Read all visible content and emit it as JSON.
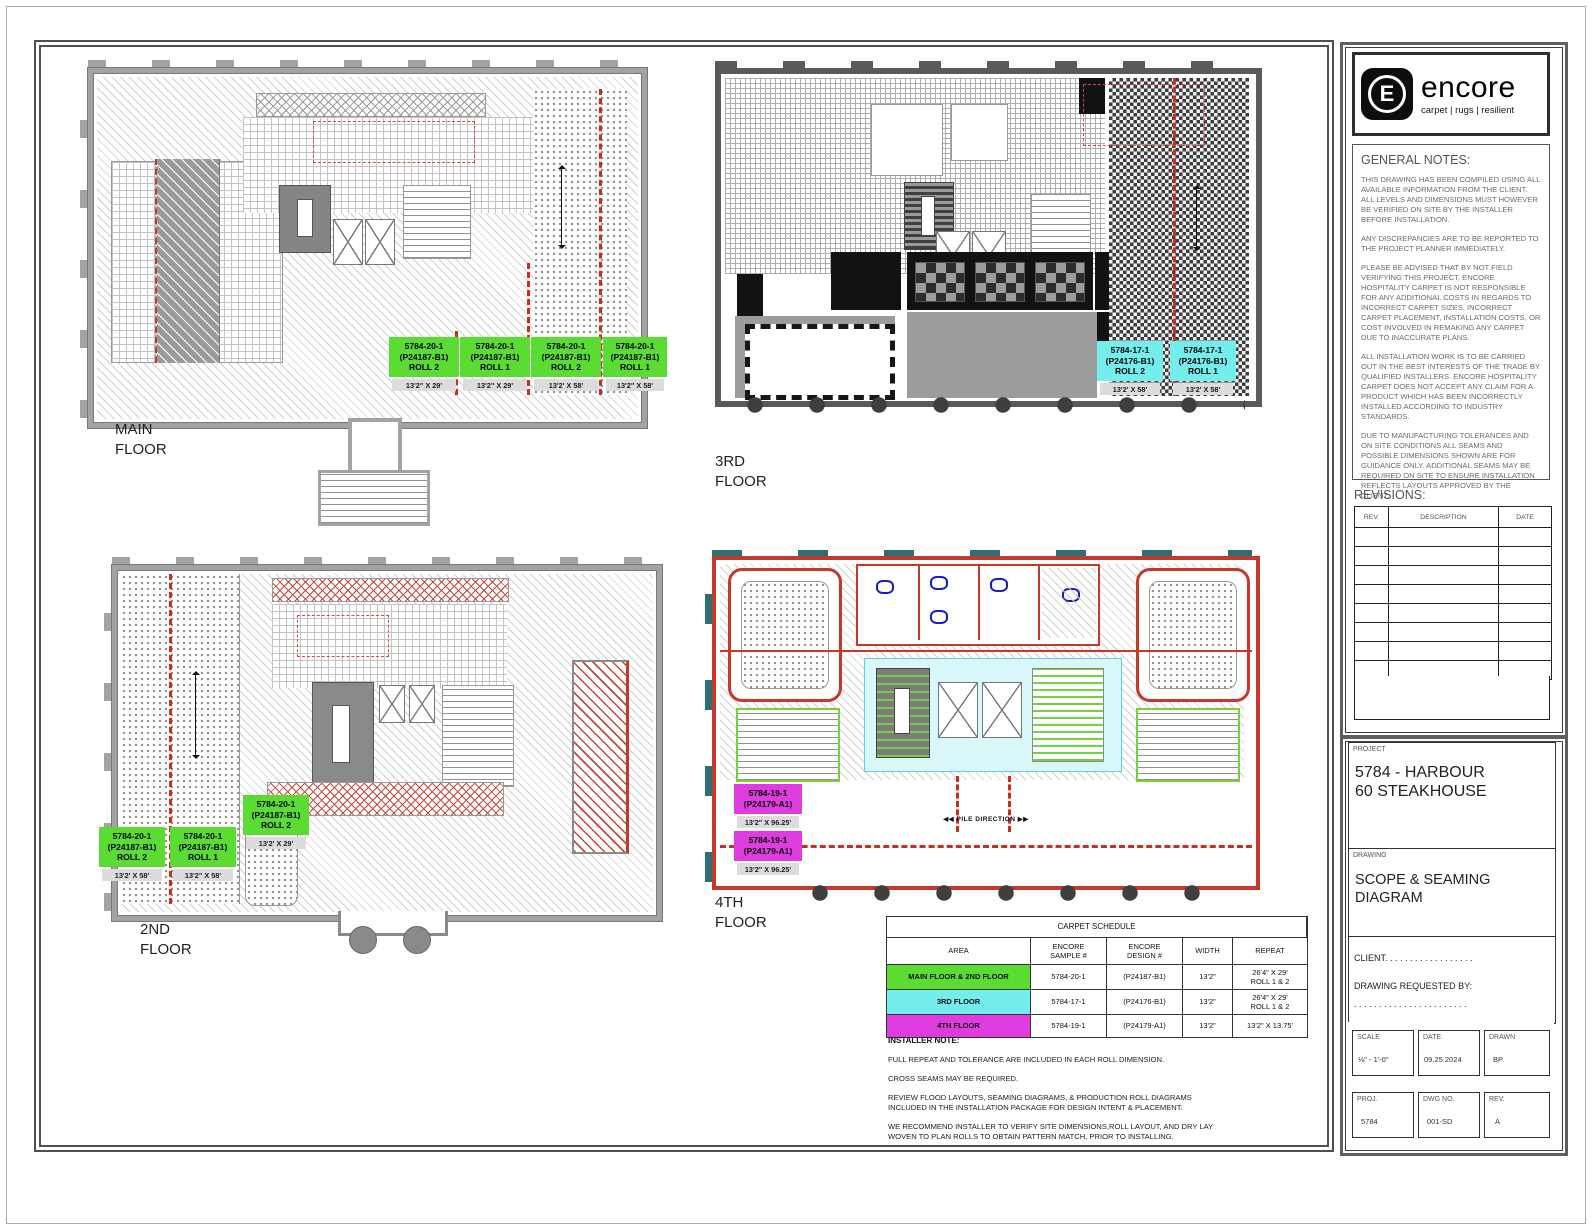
{
  "branding": {
    "logo_text": "encore",
    "logo_tagline": "carpet | rugs | resilient",
    "logo_letter": "E"
  },
  "general_notes": {
    "title": "GENERAL NOTES:",
    "paragraphs": [
      "THIS DRAWING HAS BEEN COMPILED USING ALL AVAILABLE INFORMATION FROM THE CLIENT. ALL LEVELS AND DIMENSIONS MUST HOWEVER BE VERIFIED ON SITE BY THE INSTALLER BEFORE INSTALLATION.",
      "ANY DISCREPANCIES ARE TO BE REPORTED TO THE PROJECT PLANNER IMMEDIATELY.",
      "PLEASE BE ADVISED THAT BY NOT FIELD VERIFYING THIS PROJECT, ENCORE HOSPITALITY CARPET IS NOT RESPONSIBLE FOR ANY ADDITIONAL COSTS IN REGARDS TO INCORRECT CARPET SIZES, INCORRECT CARPET PLACEMENT, INSTALLATION COSTS, OR COST INVOLVED IN REMAKING ANY CARPET DUE TO INACCURATE PLANS.",
      "ALL INSTALLATION WORK IS TO BE CARRIED OUT IN THE BEST INTERESTS OF THE TRADE BY QUALIFIED INSTALLERS.  ENCORE HOSPITALITY CARPET DOES NOT ACCEPT ANY CLAIM FOR A PRODUCT WHICH HAS BEEN INCORRECTLY INSTALLED ACCORDING TO INDUSTRY STANDARDS.",
      "DUE TO MANUFACTURING TOLERANCES AND ON SITE CONDITIONS ALL SEAMS AND POSSIBLE DIMENSIONS SHOWN ARE FOR GUIDANCE ONLY. ADDITIONAL SEAMS MAY BE REQUIRED ON SITE TO ENSURE INSTALLATION REFLECTS LAYOUTS APPROVED BY THE CLIENT."
    ]
  },
  "revisions": {
    "title": "REVISIONS:",
    "columns": [
      "REV.",
      "DESCRIPTION",
      "DATE"
    ]
  },
  "title_block": {
    "project_label": "PROJECT",
    "project_name": "5784 - HARBOUR\n60 STEAKHOUSE",
    "drawing_label": "DRAWING",
    "drawing_name": "SCOPE & SEAMING\nDIAGRAM",
    "client_line": "CLIENT. . . . . . . . . . . . . . . . . .",
    "requested_by_label": "DRAWING REQUESTED BY:",
    "requested_by_dots": ". . . . . . . . . . . . . . . . . . . . . . .",
    "scale_label": "SCALE",
    "scale_value": "⅛\" - 1'-0\"",
    "date_label": "DATE.",
    "date_value": "09.25.2024",
    "drawn_label": "DRAWN",
    "drawn_value": "BP",
    "proj_label": "PROJ.",
    "proj_value": "5784",
    "dwg_label": "DWG NO.",
    "dwg_value": "001-SD",
    "rev_label": "REV.",
    "rev_value": "A"
  },
  "floors": {
    "main": {
      "label": "MAIN\nFLOOR",
      "rolls": [
        {
          "text": "5784-20-1\n(P24187-B1)\nROLL 2",
          "dim": "13'2\" X 29'"
        },
        {
          "text": "5784-20-1\n(P24187-B1)\nROLL 1",
          "dim": "13'2\" X 29'"
        },
        {
          "text": "5784-20-1\n(P24187-B1)\nROLL 2",
          "dim": "13'2' X 58'"
        },
        {
          "text": "5784-20-1\n(P24187-B1)\nROLL 1",
          "dim": "13'2\" X 58'"
        }
      ]
    },
    "second": {
      "label": "2ND\nFLOOR",
      "rolls": [
        {
          "text": "5784-20-1\n(P24187-B1)\nROLL 2",
          "dim": "13'2' X 58'"
        },
        {
          "text": "5784-20-1\n(P24187-B1)\nROLL 1",
          "dim": "13'2\" X 58'"
        },
        {
          "text": "5784-20-1\n(P24187-B1)\nROLL 2",
          "dim": "13'2' X 29'"
        }
      ]
    },
    "third": {
      "label": "3RD\nFLOOR",
      "rolls": [
        {
          "text": "5784-17-1\n(P24176-B1)\nROLL 2",
          "dim": "13'2' X 58'"
        },
        {
          "text": "5784-17-1\n(P24176-B1)\nROLL 1",
          "dim": "13'2' X 58'"
        }
      ]
    },
    "fourth": {
      "label": "4TH\nFLOOR",
      "pile_direction": "◀◀ PILE DIRECTION ▶▶",
      "rolls": [
        {
          "text": "5784-19-1\n(P24179-A1)",
          "dim": "13'2\" X 96.25'"
        },
        {
          "text": "5784-19-1\n(P24179-A1)",
          "dim": "13'2\" X 96.25'"
        }
      ]
    }
  },
  "schedule": {
    "title": "CARPET SCHEDULE",
    "headers": [
      "AREA",
      "ENCORE\nSAMPLE #",
      "ENCORE\nDESIGN #",
      "WIDTH",
      "REPEAT"
    ],
    "rows": [
      {
        "area": "MAIN FLOOR & 2ND FLOOR",
        "sample": "5784-20-1",
        "design": "(P24187-B1)",
        "width": "13'2\"",
        "repeat": "26'4\" X 29'\nROLL 1 & 2",
        "color": "#5bdc33"
      },
      {
        "area": "3RD FLOOR",
        "sample": "5784-17-1",
        "design": "(P24176-B1)",
        "width": "13'2\"",
        "repeat": "26'4\" X 29'\nROLL 1 & 2",
        "color": "#74eded"
      },
      {
        "area": "4TH FLOOR",
        "sample": "5784-19-1",
        "design": "(P24179-A1)",
        "width": "13'2\"",
        "repeat": "13'2\" X 13.75'",
        "color": "#df3cdf"
      }
    ]
  },
  "installer": {
    "title": "INSTALLER NOTE:",
    "notes": [
      "FULL REPEAT AND TOLERANCE ARE INCLUDED IN EACH ROLL DIMENSION.",
      "CROSS SEAMS MAY BE REQUIRED.",
      "REVIEW FLOOD LAYOUTS, SEAMING DIAGRAMS, & PRODUCTION ROLL DIAGRAMS INCLUDED IN THE INSTALLATION PACKAGE FOR DESIGN INTENT & PLACEMENT.",
      "WE RECOMMEND INSTALLER TO VERIFY SITE DIMENSIONS,ROLL LAYOUT, AND DRY LAY WOVEN TO PLAN ROLLS TO OBTAIN PATTERN MATCH, PRIOR TO INSTALLING."
    ]
  },
  "colors": {
    "green": "#5bdc33",
    "cyan": "#74eded",
    "magenta": "#df3cdf",
    "seam_red": "#d12a1e",
    "wall_gray": "#a3a3a3",
    "wall_dark": "#5a5a5a",
    "wall_red": "#c4392b",
    "window_teal": "#2e6f74"
  }
}
